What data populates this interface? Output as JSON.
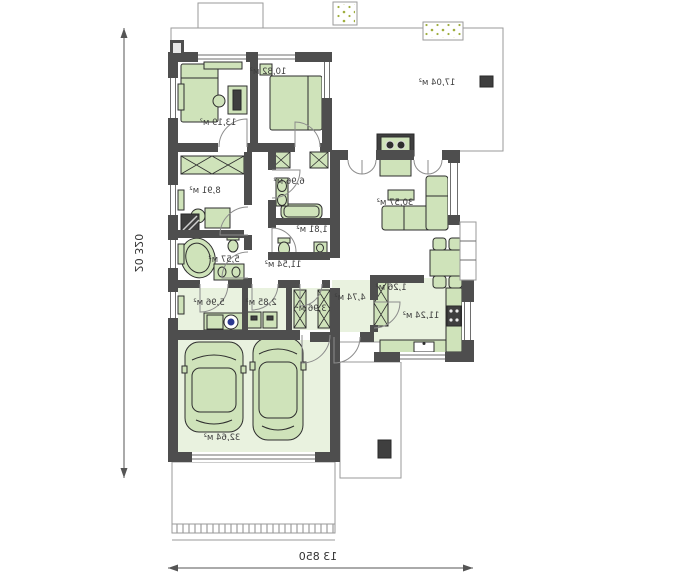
{
  "plan": {
    "type": "single-storey house floor plan, mirrored presentation",
    "rooms": [
      {
        "id": "bedroom-1",
        "area": "10,82 м²"
      },
      {
        "id": "bedroom-2",
        "area": "13,19 м²"
      },
      {
        "id": "terrace",
        "area": "17,04 м²"
      },
      {
        "id": "office",
        "area": "8,91 м²"
      },
      {
        "id": "bathroom-small",
        "area": "6,96 м²"
      },
      {
        "id": "wc",
        "area": "1,81 м²"
      },
      {
        "id": "living-room",
        "area": "30,57 м²"
      },
      {
        "id": "corridor",
        "area": "11,54 м²"
      },
      {
        "id": "bathroom-main",
        "area": "5,57 м²"
      },
      {
        "id": "laundry",
        "area": "5,96 м²"
      },
      {
        "id": "boiler-room",
        "area": "2,85 м²"
      },
      {
        "id": "wardrobe",
        "area": "3,96 м²"
      },
      {
        "id": "entry-hall",
        "area": "4,74 м²"
      },
      {
        "id": "pantry",
        "area": "1,26 м²"
      },
      {
        "id": "kitchen",
        "area": "11,24 м²"
      },
      {
        "id": "garage",
        "area": "32,64 м²"
      }
    ],
    "dimensions": {
      "total_width": "13 850",
      "total_depth": "20 320"
    }
  },
  "colors": {
    "background": "#ffffff",
    "wall": "#4e4e4e",
    "furniture_fill": "#cfe3ba",
    "furniture_stroke": "#2e2e2e",
    "floor_tint": "#e9f2df",
    "outline": "#9a9a9a",
    "dot_green": "#9fae3e",
    "washer_accent": "#2b3990",
    "dimension_text": "#333333"
  }
}
